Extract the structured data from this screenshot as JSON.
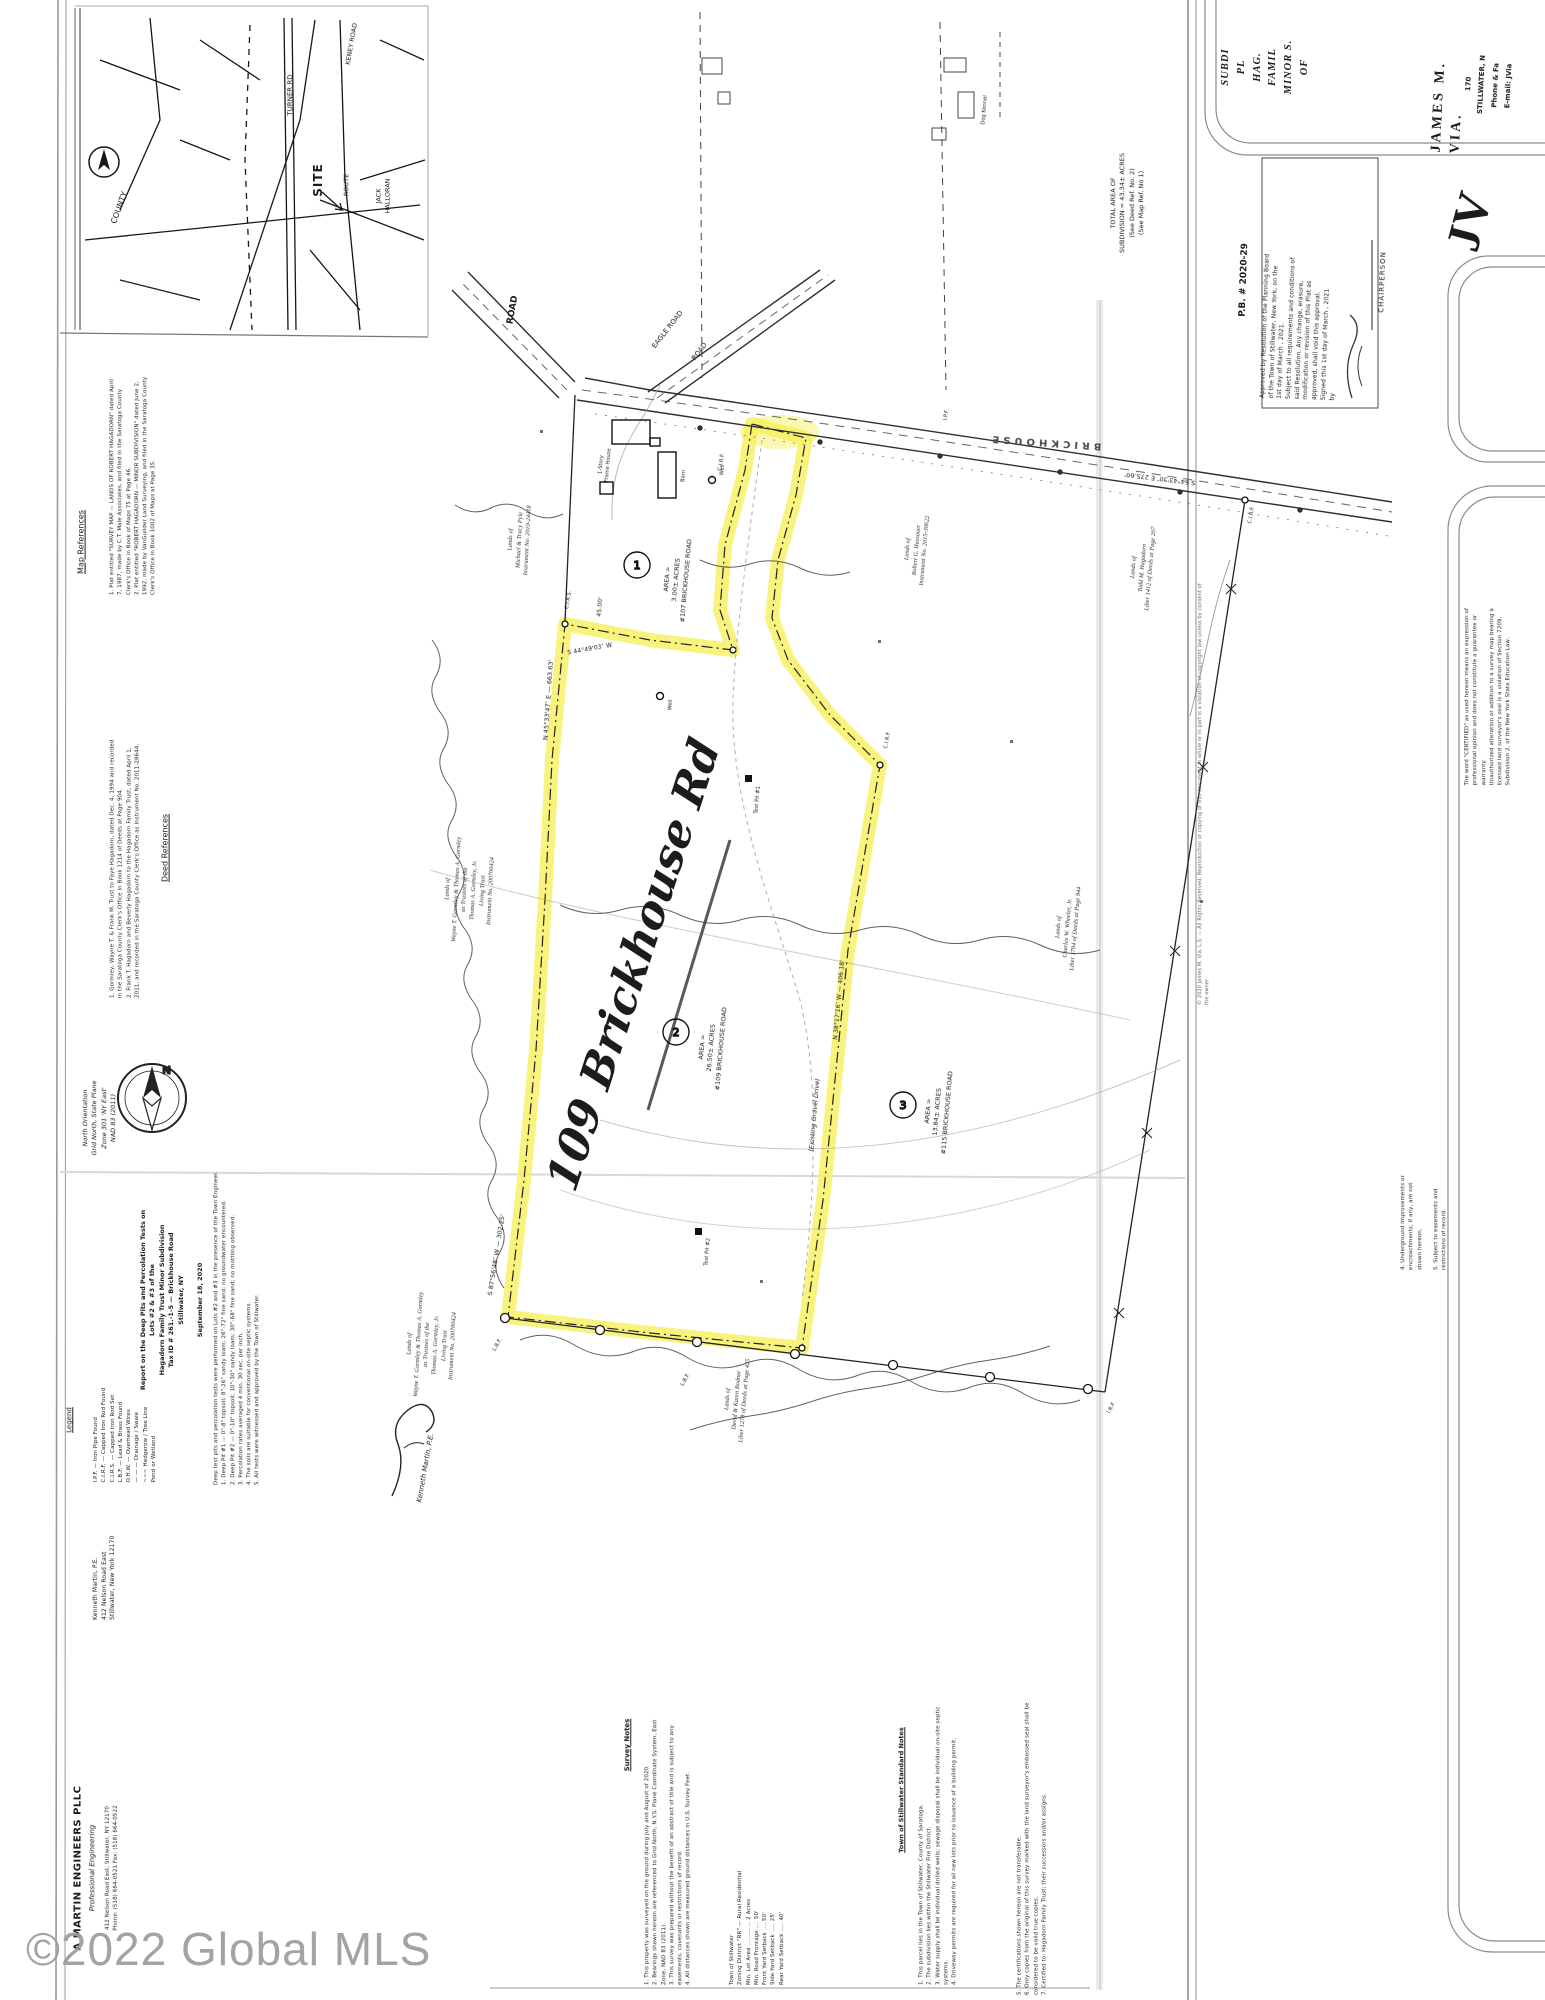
{
  "wm": "©2022 Global MLS",
  "ins": {
    "site": "SITE",
    "county": "COUNTY",
    "turner": "TURNER RD",
    "keney": "KENEY ROAD",
    "route": "ROUTE",
    "halloran": "JACK\nHALLORAN"
  },
  "lf": {
    "map_h": "Map References",
    "map_b": "1. Plat entitled \"SURVEY MAP — LANDS OF ROBERT HAGADORN\" dated April 7, 1987, made by C.T. Male Associates, and filed in the Saratoga County Clerk's Office in Book of Maps 75 at Page 46.\n2. Plat entitled \"ROBERT HAGADORN — MINOR SUBDIVISION\" dated June 2, 1992, made by VanGuilder Land Surveying, and filed in the Saratoga County Clerk's Office in Book 1002 of Maps at Page 35.",
    "deed_h": "Deed References",
    "deed_b": "1. Gormley, Wayne T. & Frank M. Trust to Faye Hagadorn, dated Dec. 4, 1994 and recorded in the Saratoga County Clerk's Office in Book 1214 of Deeds at Page 904.\n2. Frank T. Hagadorn and Beverly Hagadorn to the Hagadorn Family Trust, dated April 1, 2011, and recorded in the Saratoga County Clerk's Office as Instrument No. 2011-28644.",
    "north": "North Orientation\nGrid North, State Plane\nZone 301 'NY East'\nNAD 83 (2011)",
    "north_letter": "N",
    "legend_h": "Legend",
    "legend_b": "I.P.F. — Iron Pipe Found\nC.I.R.F. — Capped Iron Rod Found\nC.I.R.S. — Capped Iron Rod Set\nL.B.F. — Lead & Brass Found\nO.H.W. — Overhead Wires\n— — — Drainage / Swale\n~~~ Hedgerow / Tree Line\nPond or Wetland",
    "km": "Kenneth Martin, P.E.\n412 Nelson Road East\nStillwater, New York 12170"
  },
  "rp": {
    "title": "Report on the Deep Pits and Percolation Tests on\nLots #2 & #3 of the\nHagadorn Family Trust Minor Subdivision\nTax ID # 261.-1-5 — Brickhouse Road\nStillwater, NY\n\nSeptember 18, 2020",
    "body": "Deep test pits and percolation tests were performed on Lots #2 and #3 in the presence of the Town Engineer.\n1. Deep Pit #1 — 0\"-8\" topsoil; 8\"-26\" sandy loam; 26\"-72\" fine sand; no groundwater encountered.\n2. Deep Pit #2 — 0\"-10\" topsoil; 10\"-30\" sandy loam; 30\"-68\" fine sand; no mottling observed.\n3. Percolation rates averaged 4 min. 30 sec. per inch.\n4. The soils are suitable for conventional on-site septic systems.\n5. All tests were witnessed and approved by the Town of Stillwater.",
    "sig": "Kenneth Martin, P.E."
  },
  "fm": {
    "name": "A MARTIN ENGINEERS PLLC",
    "sub": "Professional Engineering",
    "addr": "412 Nelson Road East, Stillwater, NY 12170\nPhone: (518) 664-0521   Fax: (518) 664-0522"
  },
  "nt": {
    "sn_h": "Survey Notes",
    "sn_b": "1. This property was surveyed on the ground during July and August of 2020.\n2. Bearings shown hereon are referenced to Grid North, N.Y.S. Plane Coordinate System, East Zone, NAD 83 (2011).\n3. This survey was prepared without the benefit of an abstract of title and is subject to any easements, covenants or restrictions of record.\n4. All distances shown are measured ground distances in U.S. Survey Feet.",
    "zn_b": "Town of Stillwater\nZoning District \"RR\" — Rural Residential\nMin. Lot Area ............. 2 Acres\nMin. Road Frontage .... 50'\nFront Yard Setback .... 50'\nSide Yard Setback ..... 25'\nRear Yard Setback ..... 40'",
    "st_h": "Town of Stillwater Standard Notes",
    "st_b": "1. This parcel lies in the Town of Stillwater, County of Saratoga.\n2. The subdivision lies within the Stillwater Fire District.\n3. Water supply shall be individual drilled wells; sewage disposal shall be individual on-site septic systems.\n4. Driveway permits are required for all new lots prior to issuance of a building permit.",
    "ct_b": "5. The certifications shown hereon are not transferable.\n6. Only copies from the original of this survey marked with the land surveyor's embossed seal shall be considered to be valid true copies.\n7. Certified to: Hagadorn Family Trust; their successors and/or assigns."
  },
  "rs": {
    "plat_title": "SUBDI\nPL\nHAG.\nFAMIL\nMINOR S.\nOF",
    "pb": "P.B. # 2020-29",
    "approval": "Approved by Resolution of the Planning Board\nof the Town of Stillwater, New York, on the\n 1st  day of  March , 2021.\nSubject to all requirements and conditions of\nsaid Resolution. Any change, erasure,\nmodification or revision of this Plat as\napproved, shall void this approval.\nSigned this  1st  day of  March , 2021\nby",
    "chair": "CHAIRPERSON",
    "via_name": "JAMES M. VIA.",
    "via_rest": "170\nSTILLWATER, N\nPhone & Fa\nE-mail: JVia",
    "logo": "JV",
    "cert1": "The word \"CERTIFIED\" as used hereon means an expression of professional opinion and does not constitute a guarantee or warranty.\nUnauthorized alteration or addition to a survey map bearing a licensed land surveyor's seal is a violation of Section 7209, Subdivision 2, of the New York State Education Law.",
    "rnotes": "4. Underground improvements or\nencroachments, if any, are not\nshown hereon.\n\n5. Subject to easements and\nrestrictions of record.",
    "copyr": "© 2020 James M. Via, L.S. — All Rights Reserved.  Reproduction or copying of this document in whole or in part is a violation of copyright law unless by consent of the owner."
  },
  "m": {
    "total": "TOTAL AREA OF\nSUBDIVISION = 43.34± ACRES\n(See Deed Ref. No. 2)\n(See Map Ref. No 1)",
    "road_name": "BRICKHOUSE",
    "road_bear": "S 64°43'30″ E   275.60'",
    "road_w": "ROAD",
    "road_d1": "EAGLE ROAD",
    "road_d2": "ROAD",
    "bear1": "N 45°33'47″ E — 663.63'",
    "bear2": "S 87°56'48″ W — 302.25'",
    "bear3": "45.00'",
    "bear4": "S 44°49'03″ W",
    "bear5": "N 38°17'16″ W — 406.18'",
    "drive": "(Existing Gravel Drive)",
    "lot1": "1",
    "lot1_t": "AREA =\n3.00± ACRES\n#107 BRICKHOUSE ROAD",
    "lot2": "2",
    "lot2_t": "AREA =\n26.50± ACRES\n#109 BRICKHOUSE ROAD",
    "lot3": "3",
    "lot3_t": "AREA =\n13.84± ACRES\n#115 BRICKHOUSE ROAD",
    "hw": "109 Brickhouse Rd",
    "own_w": "Lands of\nWayne T. Gormley & Thomas A. Gormley\nas Trustees of the\nThomas A. Gormley, Jr.\nLiving Trust\nInstrument No. 200700424",
    "own_s": "Lands of\nWayne T. Gormley & Thomas A. Gormley\nas Trustees of the\nThomas A. Gormley, Jr.\nLiving Trust\nInstrument No. 200700424",
    "own_pyle": "Lands of\nMichael & Tracy Pyle\nInstrument No. 2010-24418",
    "own_hass": "Lands of\nRobert G. Hassauer\nInstrument No. 2015-30622",
    "own_haga": "Lands of\nTodd M. Hagadorn\nLiber 1412 of Deeds at Page 207",
    "own_wheel": "Lands of\nCharles W. Wheeler, Jr.\nLiber 1794 of Deeds at Page 944",
    "own_south": "Lands of\nDavid & Karen Bodnar\nLiber 1278 of Deeds at Page 425",
    "house1": "1-Story\nFrame House",
    "barn": "Barn",
    "kennel": "Dog Kennel",
    "well": "Well",
    "well2": "Well",
    "tp1": "Test Pit #1",
    "tp2": "Test Pit #2",
    "lbf1": "L.B.F.",
    "lbf2": "L.B.F.",
    "irf": "I.R.F.",
    "ipf": "I.P.F.",
    "cirf1": "C.I.R.F.",
    "cirf2": "C.I.R.F.",
    "cirf3": "C.I.R.F.",
    "cirs": "C.I.R.S."
  }
}
